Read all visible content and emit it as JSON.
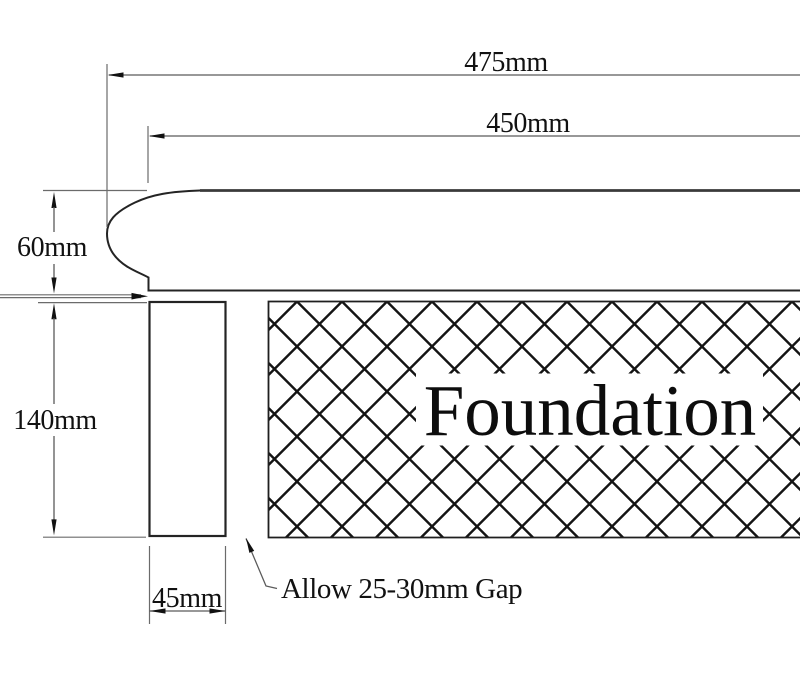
{
  "drawing": {
    "dimensions": {
      "overall_width": "475mm",
      "exposed_width": "450mm",
      "coping_thickness": "60mm",
      "wall_height": "140mm",
      "wall_width": "45mm"
    },
    "labels": {
      "foundation": "Foundation",
      "gap_note": "Allow 25-30mm Gap"
    },
    "colors": {
      "object_line": "#242424",
      "dimension_line": "#5a5a5a",
      "hatch_line": "#141414",
      "text": "#111111",
      "background": "#ffffff"
    }
  }
}
